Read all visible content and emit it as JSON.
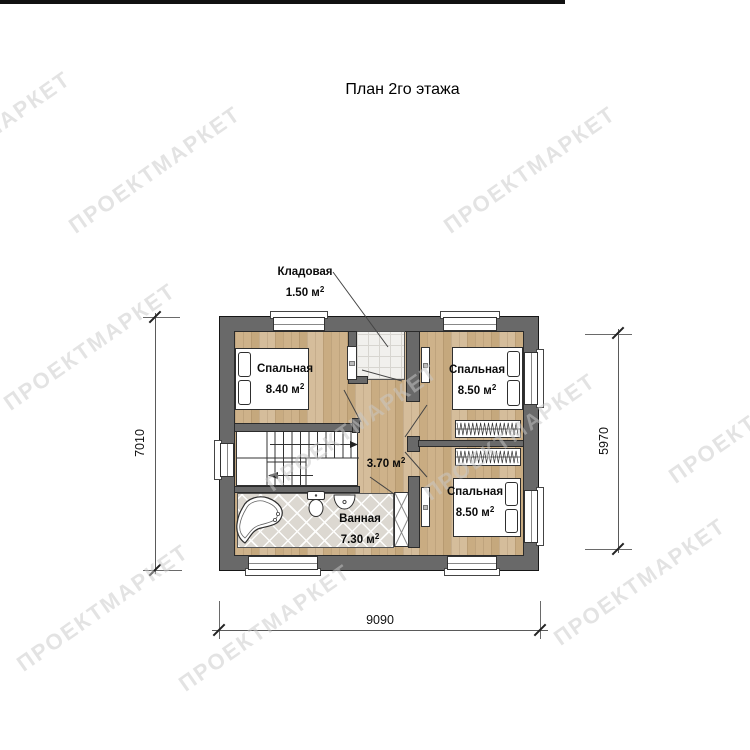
{
  "page": {
    "title": "План 2го этажа"
  },
  "watermark": {
    "text": "ПРОЕКТМАРКЕТ",
    "rotation_deg": -35,
    "color": "#c9c9c9",
    "positions": [
      {
        "x": -15,
        "y": 135
      },
      {
        "x": 155,
        "y": 170
      },
      {
        "x": 530,
        "y": 170
      },
      {
        "x": 90,
        "y": 347
      },
      {
        "x": 352,
        "y": 428
      },
      {
        "x": 510,
        "y": 437
      },
      {
        "x": 755,
        "y": 420
      },
      {
        "x": 103,
        "y": 608
      },
      {
        "x": 265,
        "y": 628
      },
      {
        "x": 640,
        "y": 582
      }
    ]
  },
  "plan": {
    "rooms": {
      "storage": {
        "name": "Кладовая",
        "area": "1.50 м",
        "sup": "2"
      },
      "bedroom_top_left": {
        "name": "Спальная",
        "area": "8.40 м",
        "sup": "2"
      },
      "bedroom_top_right": {
        "name": "Спальная",
        "area": "8.50 м",
        "sup": "2"
      },
      "bedroom_bottom_right": {
        "name": "Спальная",
        "area": "8.50 м",
        "sup": "2"
      },
      "hall": {
        "area": "3.70 м",
        "sup": "2"
      },
      "bathroom": {
        "name": "Ванная",
        "area": "7.30 м",
        "sup": "2"
      }
    }
  },
  "dimensions": {
    "left": "7010",
    "right": "5970",
    "bottom": "9090"
  },
  "colors": {
    "wall": "#696969",
    "wood": "#cdb28c",
    "tile": "#dcd8d1",
    "outline": "#161616"
  }
}
